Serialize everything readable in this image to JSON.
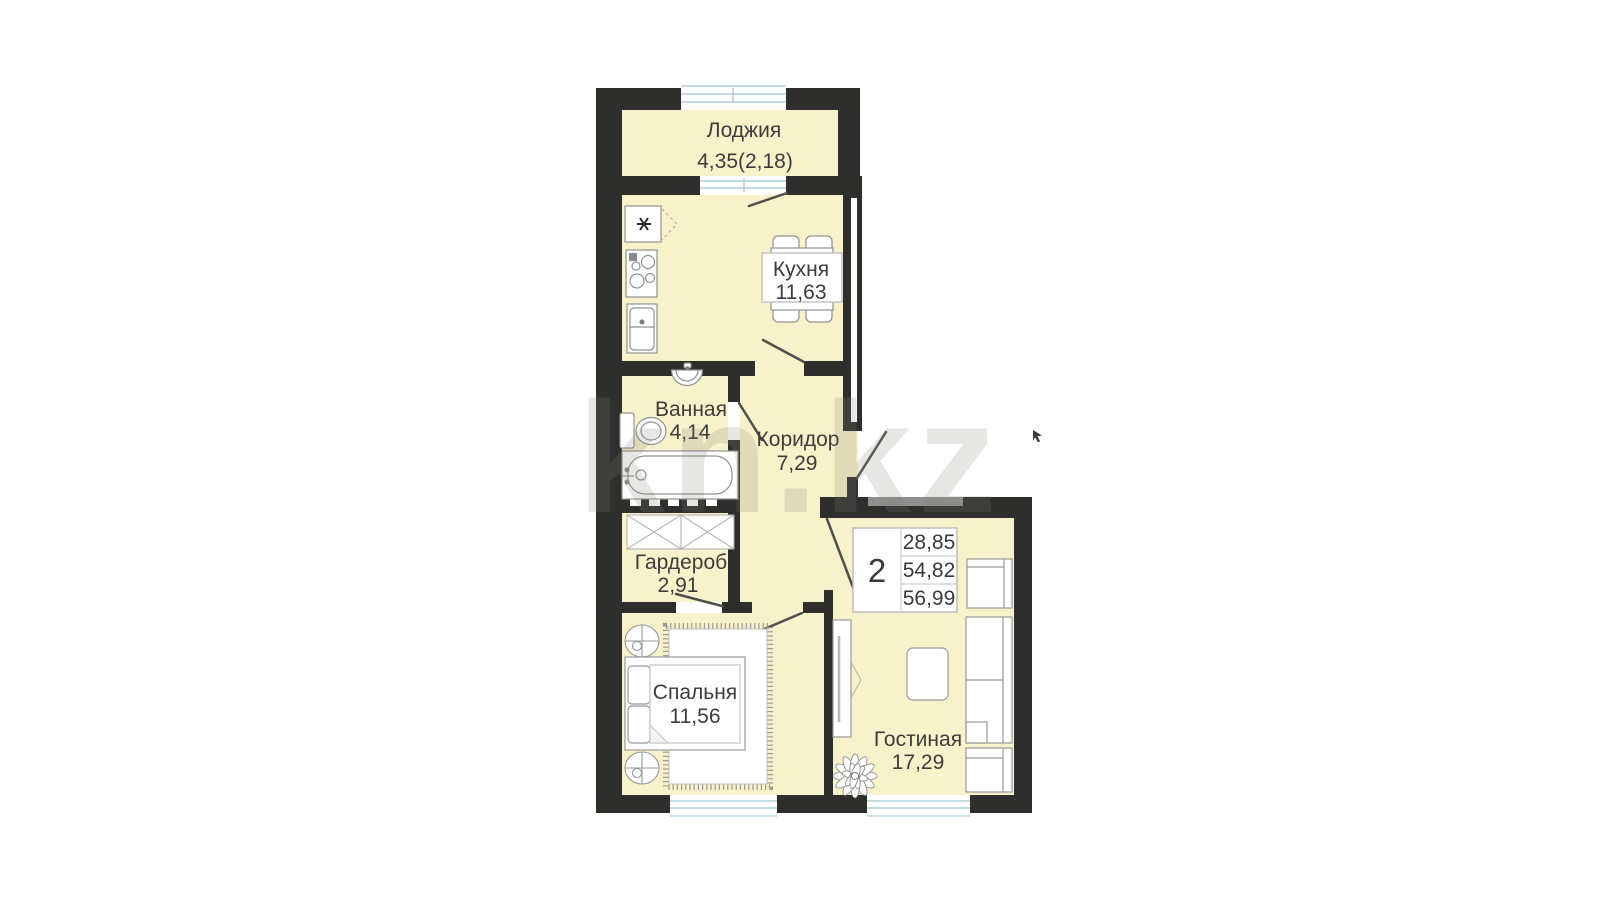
{
  "watermark": {
    "text": "kn.kz"
  },
  "rooms": {
    "loggia": {
      "name": "Лоджия",
      "area": "4,35(2,18)"
    },
    "kitchen": {
      "name": "Кухня",
      "area": "11,63"
    },
    "bathroom": {
      "name": "Ванная",
      "area": "4,14"
    },
    "corridor": {
      "name": "Коридор",
      "area": "7,29"
    },
    "wardrobe": {
      "name": "Гардероб",
      "area": "2,91"
    },
    "bedroom": {
      "name": "Спальня",
      "area": "11,56"
    },
    "living": {
      "name": "Гостиная",
      "area": "17,29"
    }
  },
  "info_box": {
    "rooms_count": "2",
    "rows": [
      "28,85",
      "54,82",
      "56,99"
    ]
  },
  "colors": {
    "wall": "#2e2e2c",
    "floor": "#f7f2ca",
    "window_glass": "#aed3da",
    "label_text": "#3c3c3c"
  }
}
